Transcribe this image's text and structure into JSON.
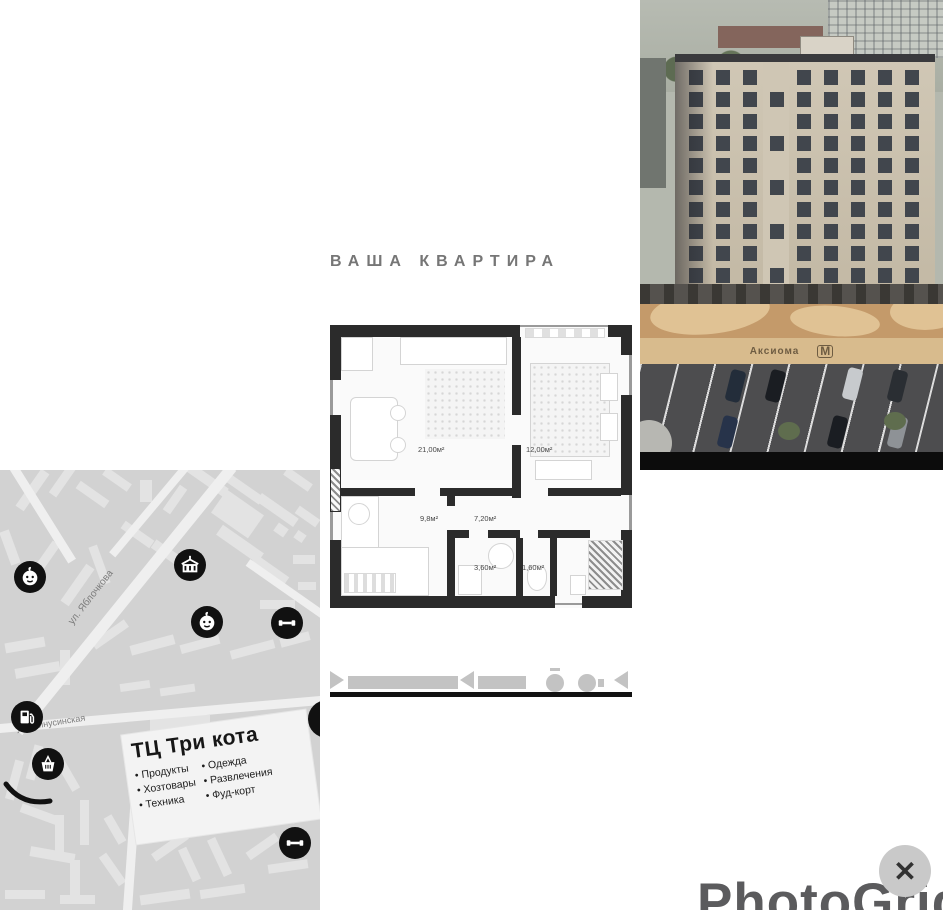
{
  "collage": {
    "title": "ВАША КВАРТИРА",
    "floorplan": {
      "rooms": [
        {
          "id": "living",
          "area": "21,00м²"
        },
        {
          "id": "bedroom",
          "area": "12,00м²"
        },
        {
          "id": "kitchen",
          "area": "9,8м²"
        },
        {
          "id": "hall",
          "area": "7,20м²"
        },
        {
          "id": "bathroom",
          "area": "3,60м²"
        },
        {
          "id": "wc",
          "area": "1,60м²"
        }
      ]
    },
    "map": {
      "streets": [
        {
          "name": "ул. Яблочкова"
        },
        {
          "name": "ул. Минусинская"
        }
      ],
      "mall_card": {
        "title": "ТЦ Три кота",
        "items_left": [
          "Продукты",
          "Хозтовары",
          "Техника"
        ],
        "items_right": [
          "Одежда",
          "Развлечения",
          "Фуд-корт"
        ]
      },
      "poi_icons": [
        "kindergarten-icon",
        "school-icon",
        "kindergarten-icon",
        "gym-icon",
        "fuel-station-icon",
        "grocery-icon",
        "gym-icon"
      ]
    },
    "photo": {
      "fence_brand": "Аксиома",
      "fence_logo": "М"
    },
    "watermark": "PhotoGrid",
    "close_label": "✕"
  },
  "colors": {
    "map_bg": "#d2d2d2",
    "wall": "#2b2b2b",
    "facade": "#c9bfae",
    "asphalt": "#4d4d4f",
    "accent_black": "#111111"
  }
}
